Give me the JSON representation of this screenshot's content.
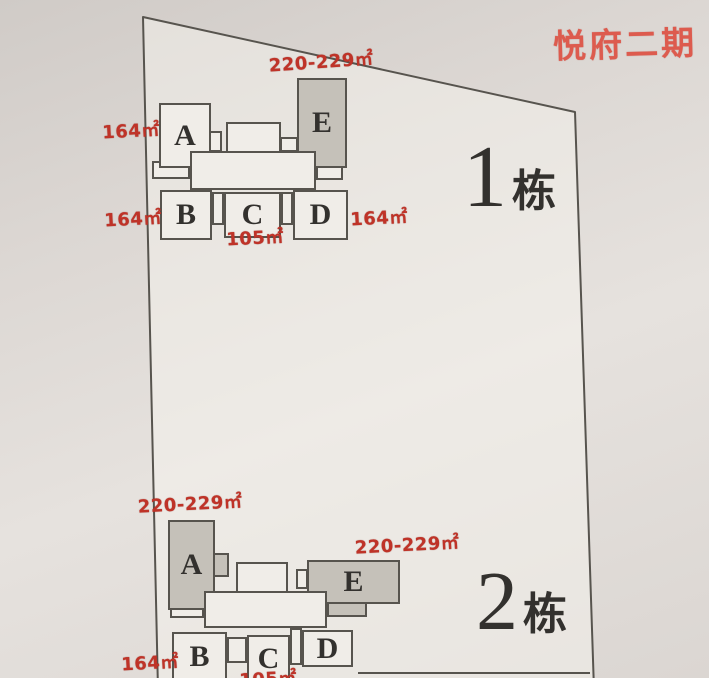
{
  "title": "悦府二期",
  "colors": {
    "title_red": "#dd5b4e",
    "area_red": "#bf3328",
    "ink": "#33312e",
    "line": "#57544e",
    "unit_fill": "#f0ede8",
    "unit_gray": "#c5c1b9",
    "paper": "#ded9d5"
  },
  "buildings": [
    {
      "label_number": "1",
      "label_suffix": "栋",
      "units": {
        "a": "A",
        "b": "B",
        "c": "C",
        "d": "D",
        "e": "E"
      },
      "areas": {
        "e_top": "220-229㎡",
        "a_left": "164㎡",
        "b_left": "164㎡",
        "d_right": "164㎡",
        "c_bottom": "105㎡"
      }
    },
    {
      "label_number": "2",
      "label_suffix": "栋",
      "units": {
        "a": "A",
        "b": "B",
        "c": "C",
        "d": "D",
        "e": "E"
      },
      "areas": {
        "a_top": "220-229㎡",
        "e_top": "220-229㎡",
        "b_left": "164㎡",
        "c_bottom": "105㎡"
      }
    }
  ]
}
